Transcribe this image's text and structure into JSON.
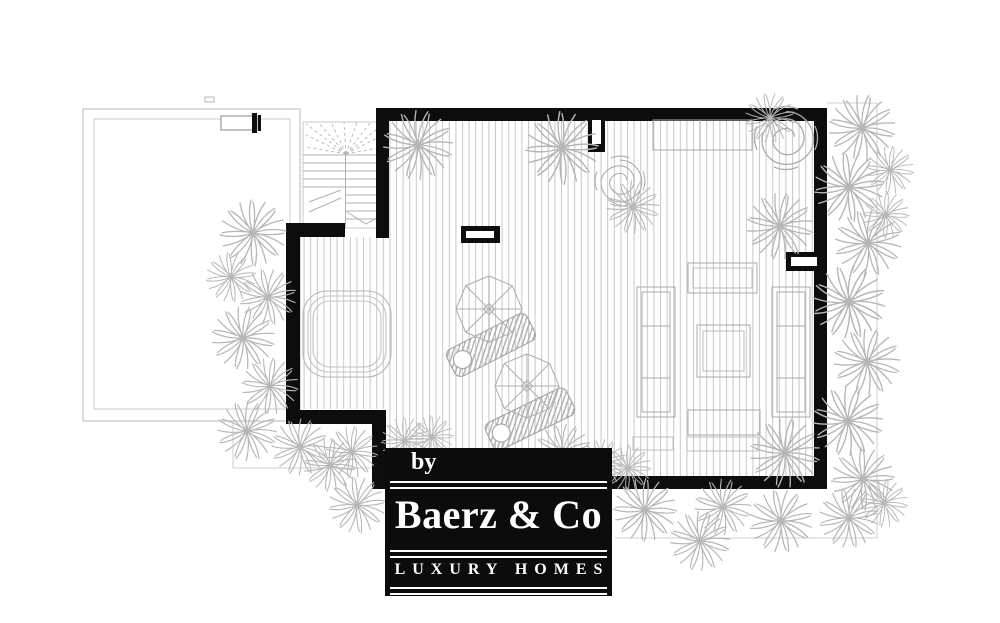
{
  "logo": {
    "prefix": "by",
    "brand": "Baerz & Co",
    "tagline": "LUXURY HOMES"
  },
  "colors": {
    "wall": "#0d0d0d",
    "logo_background": "#0c0c0c",
    "logo_text": "#ffffff",
    "deck_line": "#c7c7c7",
    "furniture_line": "#a8a8a8",
    "plant": "#b6b6b6",
    "faint_boundary": "#cfcfcf"
  },
  "plan": {
    "palms": [
      {
        "x": 253,
        "y": 233,
        "s": 1.0,
        "r": 0
      },
      {
        "x": 231,
        "y": 277,
        "s": 0.75,
        "r": 40
      },
      {
        "x": 268,
        "y": 297,
        "s": 0.85,
        "r": 80
      },
      {
        "x": 243,
        "y": 338,
        "s": 0.95,
        "r": 15
      },
      {
        "x": 270,
        "y": 386,
        "s": 0.85,
        "r": 55
      },
      {
        "x": 247,
        "y": 431,
        "s": 0.9,
        "r": 25
      },
      {
        "x": 300,
        "y": 447,
        "s": 0.85,
        "r": 70
      },
      {
        "x": 330,
        "y": 465,
        "s": 0.8,
        "r": 10
      },
      {
        "x": 357,
        "y": 505,
        "s": 0.85,
        "r": 40
      },
      {
        "x": 352,
        "y": 452,
        "s": 0.78,
        "r": 10
      },
      {
        "x": 405,
        "y": 441,
        "s": 0.72,
        "r": 45
      },
      {
        "x": 432,
        "y": 437,
        "s": 0.65,
        "r": 90
      },
      {
        "x": 418,
        "y": 145,
        "s": 1.05,
        "r": 20
      },
      {
        "x": 562,
        "y": 148,
        "s": 1.1,
        "r": 0
      },
      {
        "x": 633,
        "y": 207,
        "s": 0.8,
        "r": 20
      },
      {
        "x": 770,
        "y": 118,
        "s": 0.75,
        "r": 35
      },
      {
        "x": 780,
        "y": 226,
        "s": 1.0,
        "r": 60
      },
      {
        "x": 785,
        "y": 453,
        "s": 1.05,
        "r": 15
      },
      {
        "x": 563,
        "y": 452,
        "s": 0.85,
        "r": 30
      },
      {
        "x": 602,
        "y": 463,
        "s": 0.72,
        "r": 75
      },
      {
        "x": 628,
        "y": 468,
        "s": 0.7,
        "r": 5
      },
      {
        "x": 645,
        "y": 510,
        "s": 0.95,
        "r": 50
      },
      {
        "x": 700,
        "y": 541,
        "s": 0.9,
        "r": 20
      },
      {
        "x": 723,
        "y": 507,
        "s": 0.85,
        "r": 65
      },
      {
        "x": 781,
        "y": 521,
        "s": 0.95,
        "r": 35
      },
      {
        "x": 849,
        "y": 518,
        "s": 0.9,
        "r": 80
      },
      {
        "x": 884,
        "y": 503,
        "s": 0.72,
        "r": 10
      },
      {
        "x": 862,
        "y": 128,
        "s": 1.0,
        "r": 15
      },
      {
        "x": 890,
        "y": 170,
        "s": 0.72,
        "r": 55
      },
      {
        "x": 849,
        "y": 187,
        "s": 1.05,
        "r": 40
      },
      {
        "x": 868,
        "y": 243,
        "s": 1.0,
        "r": 75
      },
      {
        "x": 886,
        "y": 215,
        "s": 0.7,
        "r": 5
      },
      {
        "x": 849,
        "y": 302,
        "s": 1.1,
        "r": 30
      },
      {
        "x": 867,
        "y": 362,
        "s": 1.0,
        "r": 65
      },
      {
        "x": 848,
        "y": 421,
        "s": 1.05,
        "r": 20
      },
      {
        "x": 863,
        "y": 479,
        "s": 0.95,
        "r": 45
      }
    ],
    "swirl_shrubs": [
      {
        "x": 620,
        "y": 181,
        "s": 0.95
      },
      {
        "x": 786,
        "y": 138,
        "s": 1.2
      }
    ],
    "parasols": [
      {
        "x": 489,
        "y": 309,
        "s": 1.0
      },
      {
        "x": 527,
        "y": 386,
        "s": 0.97
      }
    ],
    "sun_loungers": [
      {
        "x": 491,
        "y": 345,
        "a": -27
      },
      {
        "x": 530,
        "y": 419,
        "a": -26
      }
    ]
  }
}
